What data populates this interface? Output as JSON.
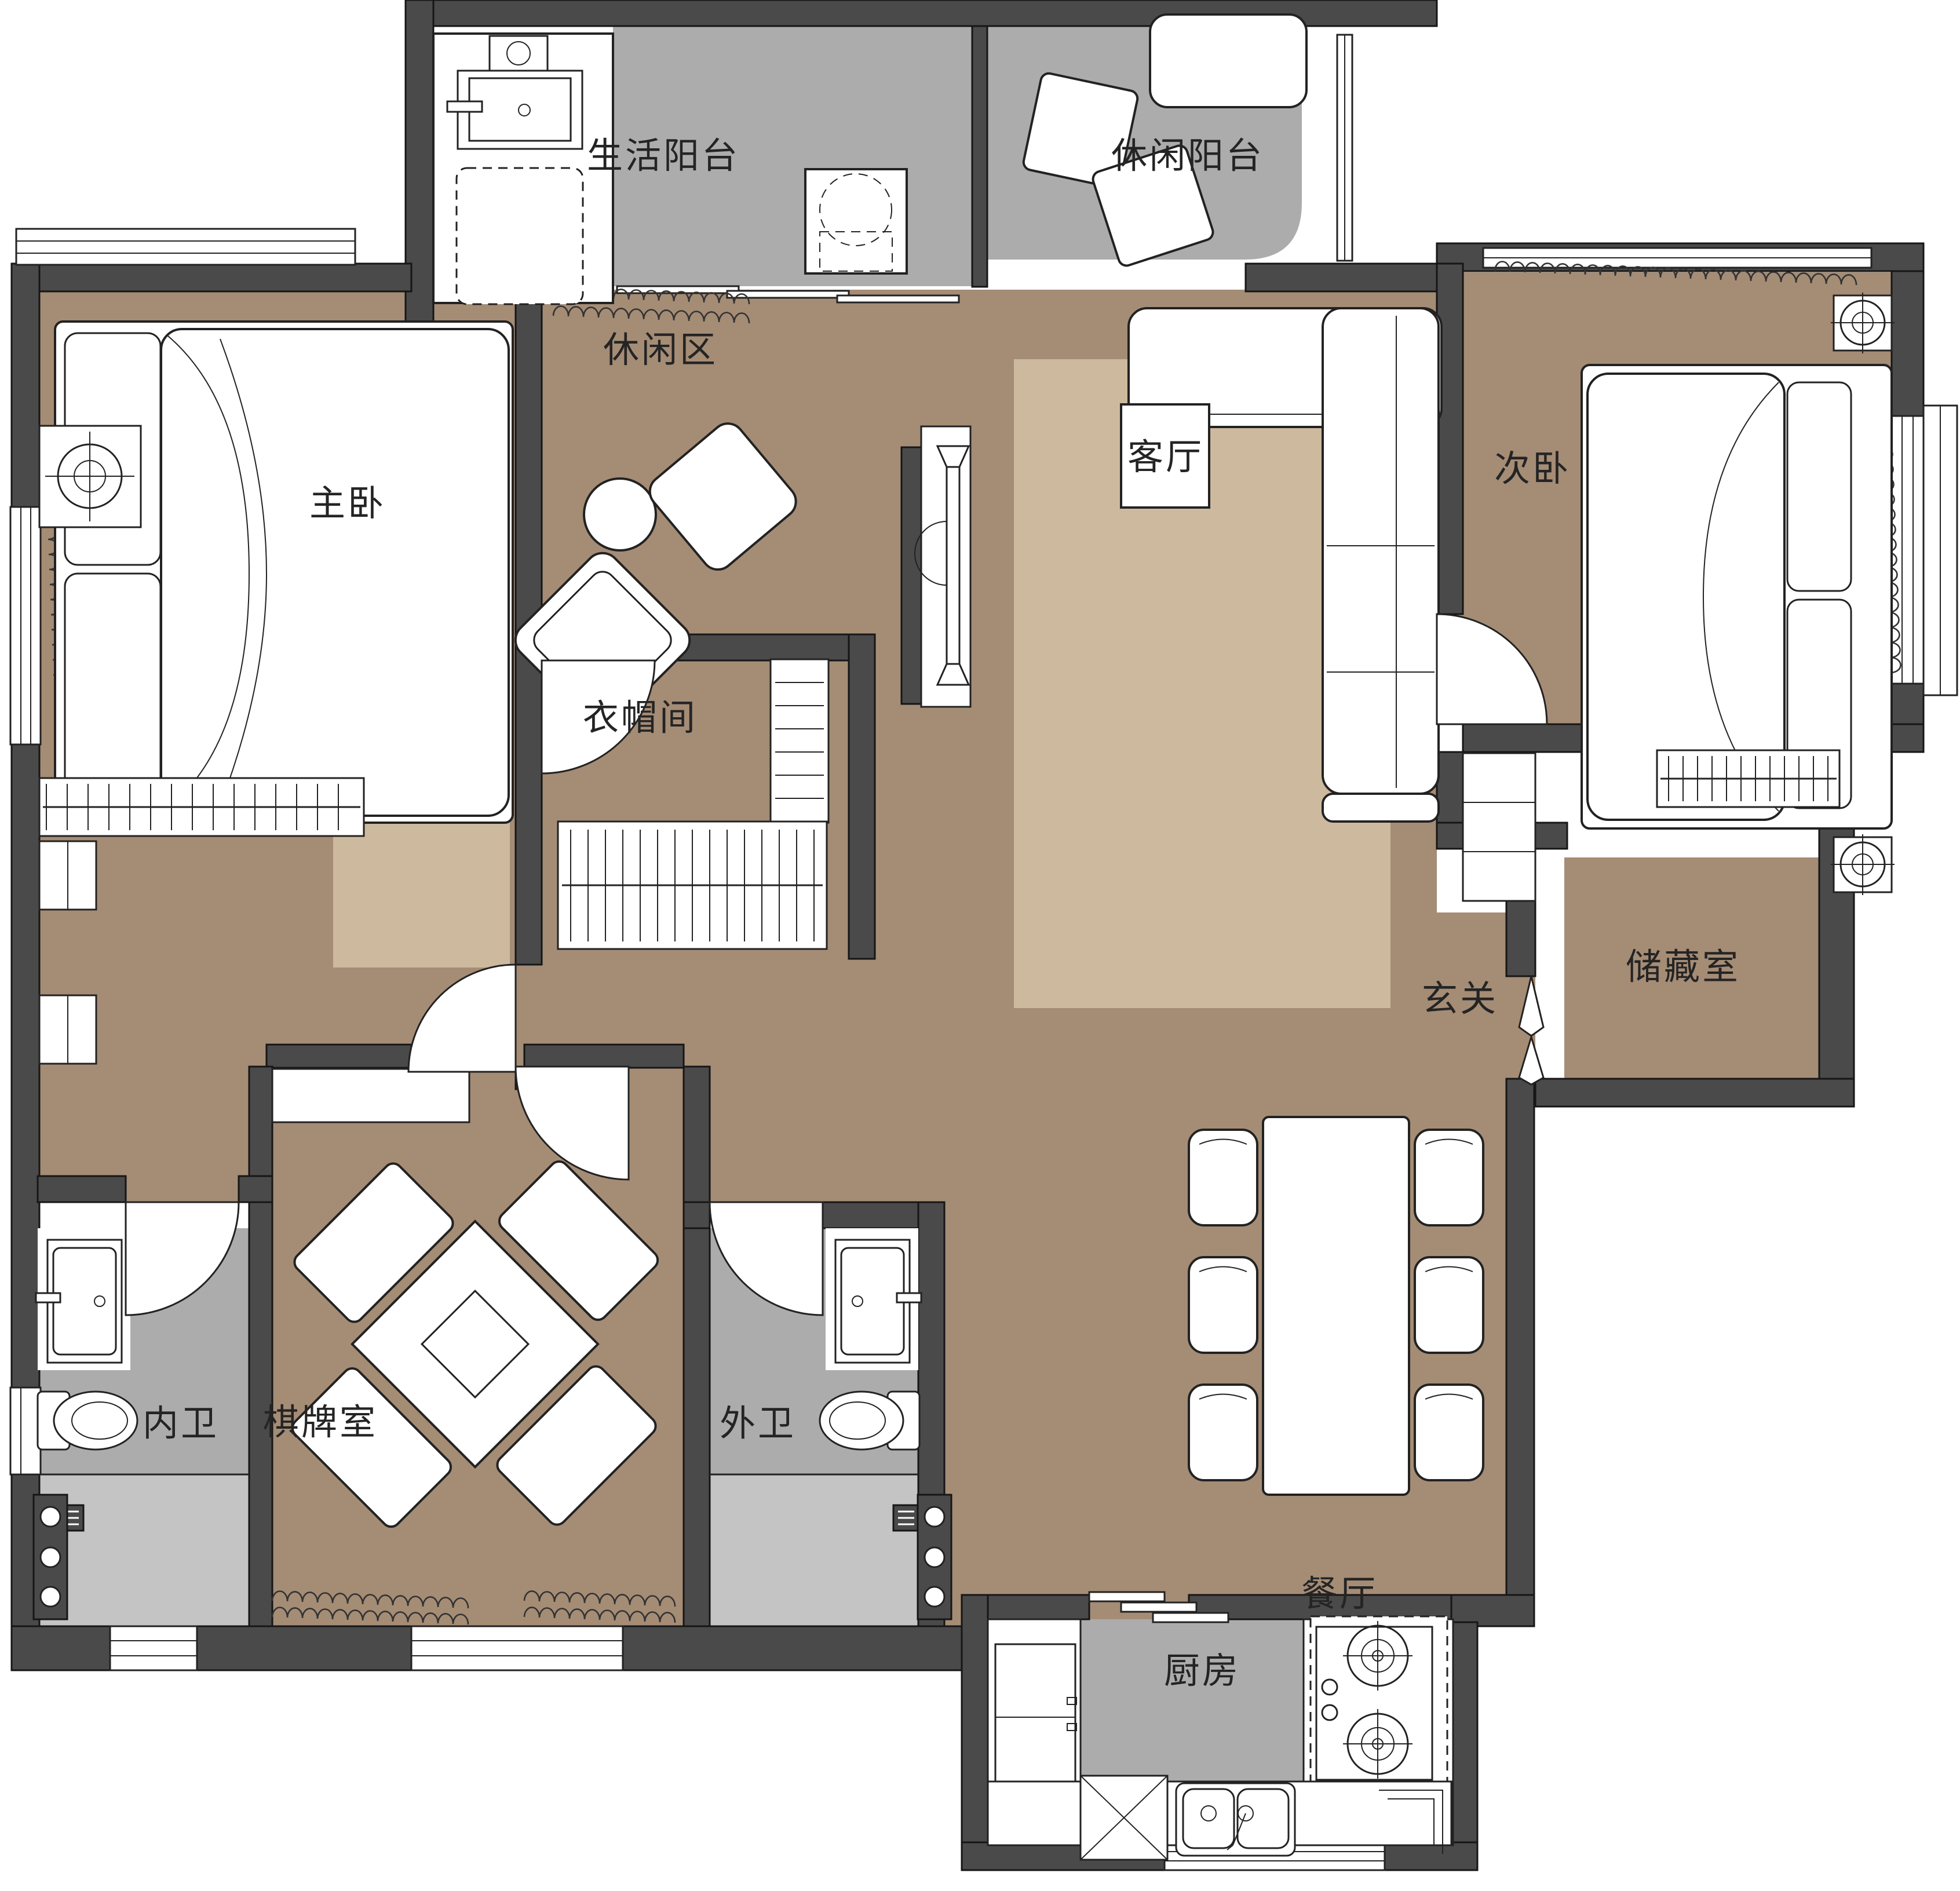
{
  "title": "户型平面图",
  "colors": {
    "wall": "#4A4A4A",
    "floor": "#A58C75",
    "rug": "#CDB99E",
    "wet_floor": "#ACACAC",
    "shower_floor": "#C4C4C4",
    "white": "#FFFFFF",
    "line": "#222222",
    "label": "#242424"
  },
  "rooms": {
    "life_balcony": {
      "label": "生活阳台"
    },
    "leisure_balcony": {
      "label": "休闲阳台"
    },
    "leisure_area": {
      "label": "休闲区"
    },
    "master_bedroom": {
      "label": "主卧"
    },
    "living_room": {
      "label": "客厅"
    },
    "second_bedroom": {
      "label": "次卧"
    },
    "cloakroom": {
      "label": "衣帽间"
    },
    "entry_hall": {
      "label": "玄关"
    },
    "storage_room": {
      "label": "储藏室"
    },
    "inner_bathroom": {
      "label": "内卫"
    },
    "game_room": {
      "label": "棋牌室"
    },
    "outer_bathroom": {
      "label": "外卫"
    },
    "dining_room": {
      "label": "餐厅"
    },
    "kitchen": {
      "label": "厨房"
    }
  }
}
